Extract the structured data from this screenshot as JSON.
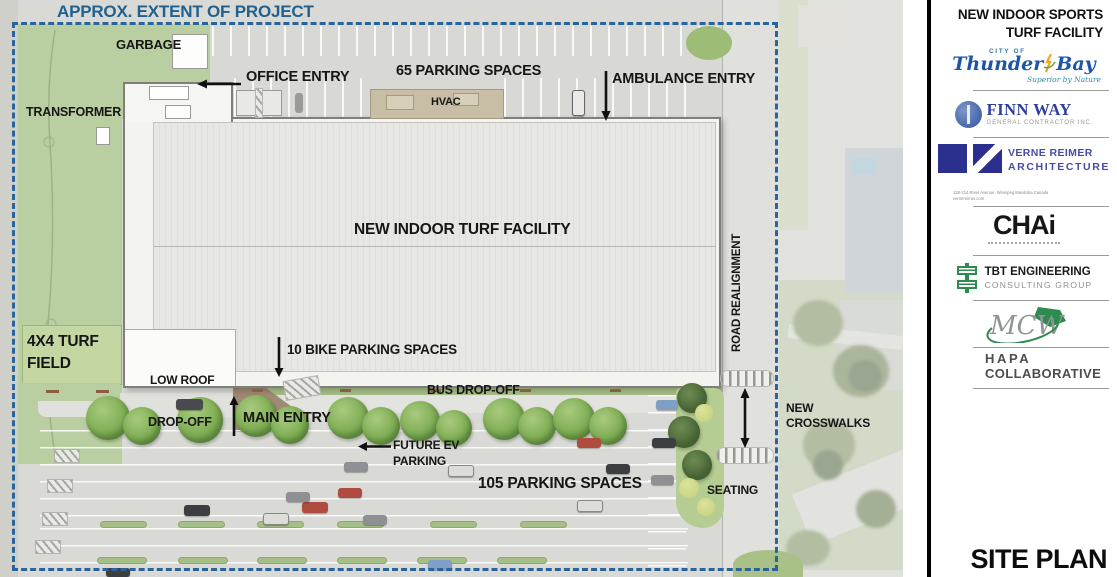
{
  "plan": {
    "extent_label": "APPROX. EXTENT OF PROJECT",
    "labels": {
      "garbage": "GARBAGE",
      "office_entry": "OFFICE ENTRY",
      "parking_65": "65 PARKING SPACES",
      "ambulance_entry": "AMBULANCE ENTRY",
      "hvac": "HVAC",
      "transformer": "TRANSFORMER",
      "facility": "NEW INDOOR TURF FACILITY",
      "road_realignment": "ROAD REALIGNMENT",
      "turf_field": "4X4 TURF\nFIELD",
      "bike_parking": "10 BIKE PARKING SPACES",
      "low_roof": "LOW ROOF",
      "drop_off": "DROP-OFF",
      "main_entry": "MAIN ENTRY",
      "bus_drop_off": "BUS DROP-OFF",
      "future_ev": "FUTURE EV\nPARKING",
      "parking_105": "105 PARKING SPACES",
      "seating": "SEATING",
      "new_crosswalks": "NEW\nCROSSWALKS"
    }
  },
  "sidebar": {
    "title": "NEW INDOOR SPORTS\nTURF FACILITY",
    "logos": {
      "thunder_bay": {
        "city_of": "CITY OF",
        "name1": "Thunder",
        "name2": "Bay",
        "tagline": "Superior by Nature"
      },
      "finn_way": {
        "name": "FINN WAY",
        "sub": "GENERAL CONTRACTOR INC."
      },
      "verne_reimer": {
        "line1": "VERNE REIMER",
        "line2": "ARCHITECTURE",
        "address": "128-214 River Avenue, Winnipeg Manitoba Canada",
        "website": "vernereimer.com"
      },
      "chai": {
        "name": "CHAi"
      },
      "tbt": {
        "line1": "TBT ENGINEERING",
        "line2": "CONSULTING GROUP"
      },
      "mcw": {
        "name": "MCW"
      },
      "hapa": {
        "line1": "HAPA",
        "line2": "COLLABORATIVE"
      }
    },
    "footer": "SITE PLAN"
  },
  "colors": {
    "extent_blue": "#2a649c",
    "grass_green": "#b9cfa1",
    "asphalt_gray": "#d9dad5",
    "hvac_tan": "#c8bda5",
    "thunder_bay_blue": "#1d55a8",
    "finn_way_blue": "#2b3f9c",
    "verne_reimer_navy": "#2b2f8e",
    "tbt_green": "#2f8a50",
    "mcw_green": "#2f8a4f"
  }
}
